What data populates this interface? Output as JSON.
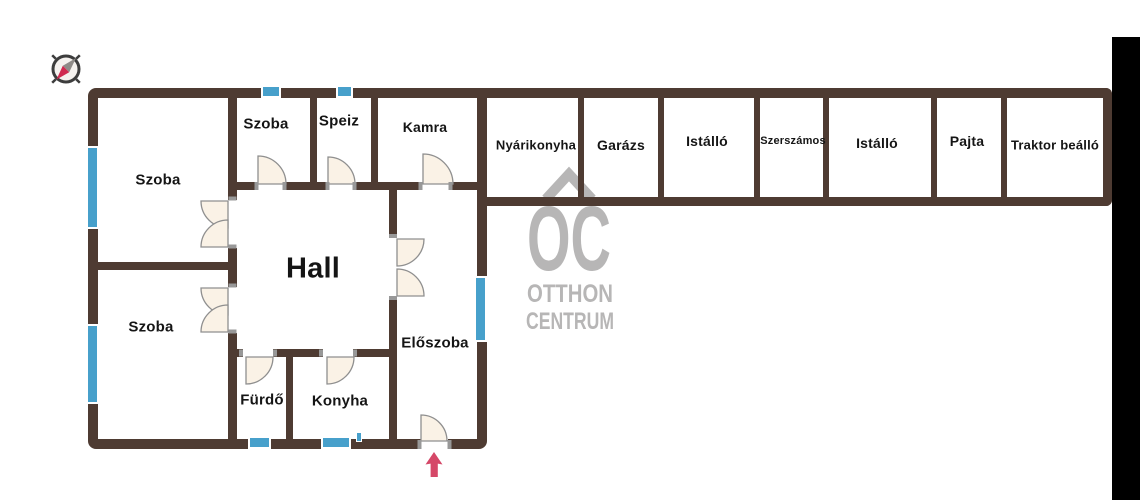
{
  "colors": {
    "wall": "#4e3b32",
    "window_blue": "#47a0cb",
    "door_fill": "#faf2e6",
    "entrance_arrow_red": "#d54868",
    "watermark_gray": "#b7b6b6",
    "side_bar_black": "#000000"
  },
  "main_house": {
    "rooms": [
      {
        "label": "Szoba"
      },
      {
        "label": "Szoba"
      },
      {
        "label": "Szoba"
      },
      {
        "label": "Speiz"
      },
      {
        "label": "Kamra"
      },
      {
        "label": "Hall"
      },
      {
        "label": "Előszoba"
      },
      {
        "label": "Fürdő"
      },
      {
        "label": "Konyha"
      }
    ]
  },
  "outbuildings": {
    "rooms": [
      {
        "label": "Nyárikonyha"
      },
      {
        "label": "Garázs"
      },
      {
        "label": "Istálló"
      },
      {
        "label": "Szerszámos"
      },
      {
        "label": "Istálló"
      },
      {
        "label": "Pajta"
      },
      {
        "label": "Traktor beálló"
      }
    ]
  },
  "watermark": {
    "monogram": "OC",
    "line1": "OTTHON",
    "line2": "CENTRUM"
  },
  "icons": {
    "compass": "compass-rose-icon",
    "entrance": "entrance-arrow-icon"
  }
}
